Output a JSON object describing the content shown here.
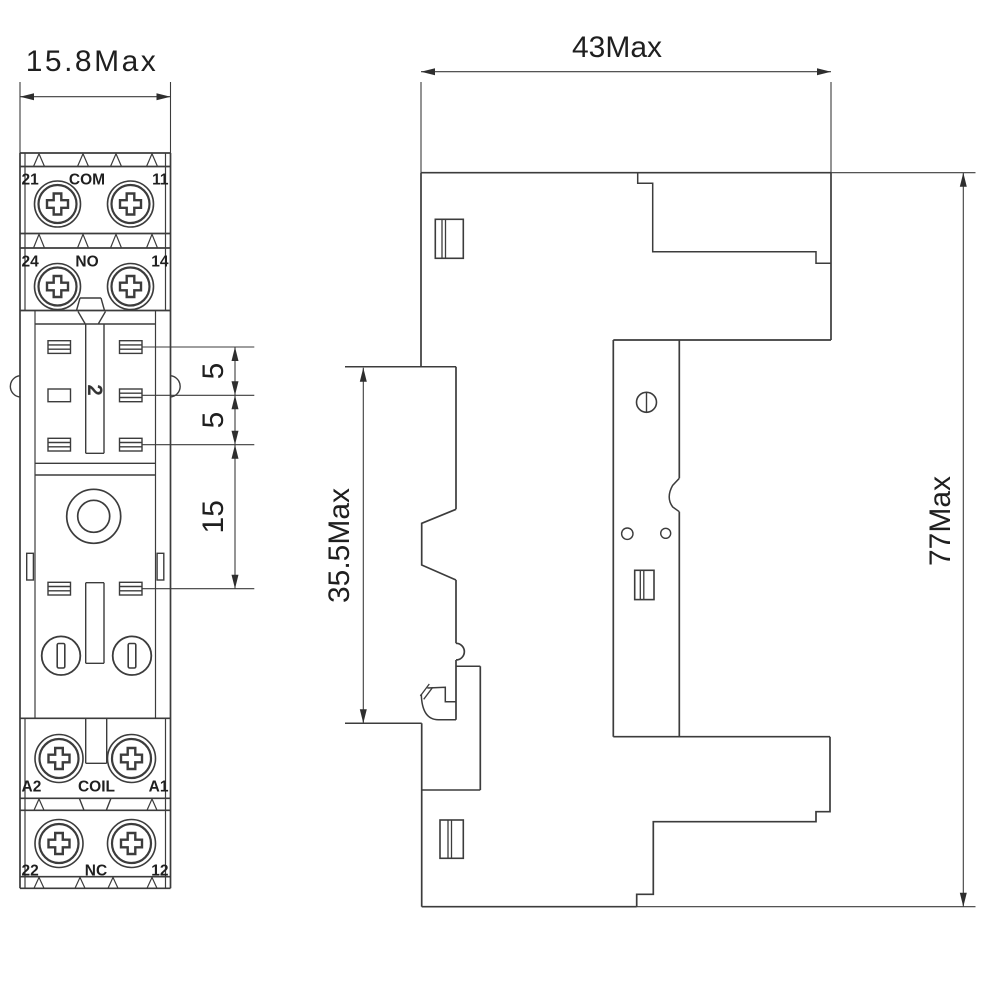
{
  "drawing": {
    "front_view": {
      "width_dim": "15.8Max",
      "pitch_dims": {
        "d1": "5",
        "d2": "5",
        "d3": "15"
      },
      "socket_number": "2",
      "row1": {
        "left": "21",
        "center": "COM",
        "right": "11"
      },
      "row2": {
        "left": "24",
        "center": "NO",
        "right": "14"
      },
      "row3": {
        "left": "A2",
        "center": "COIL",
        "right": "A1"
      },
      "row4": {
        "left": "22",
        "center": "NC",
        "right": "12"
      }
    },
    "side_view": {
      "width_dim": "43Max",
      "height_dim": "77Max",
      "depth_dim": "35.5Max"
    },
    "line_color": "#3c3c3c",
    "text_color": "#1f1f1f"
  }
}
